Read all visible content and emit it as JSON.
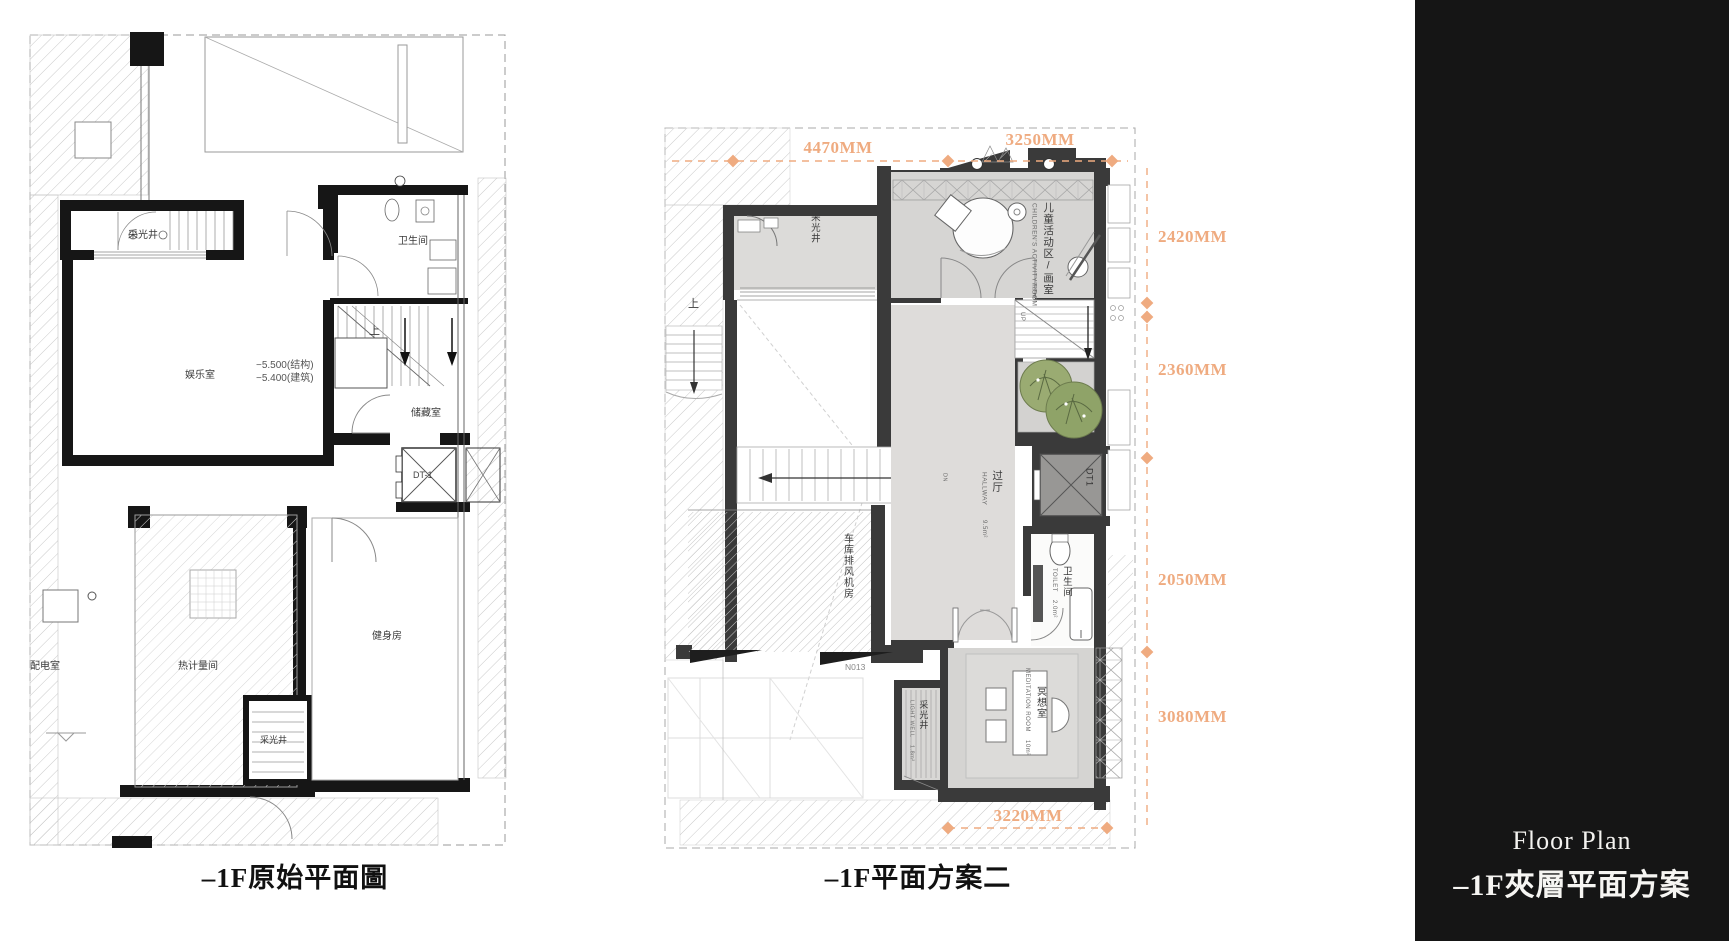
{
  "colors": {
    "dimension_accent": "#efab80",
    "wall_left_plan": "#161616",
    "wall_middle_plan": "#3a3a3a",
    "room_fill": "#d6d5d3",
    "hallway_fill": "#dedcda",
    "tree_green": "#93a56a",
    "panel_background": "#151515",
    "panel_text": "#f4f3f1"
  },
  "left_plan": {
    "caption": "–1F原始平面圖",
    "labels": {
      "light_well_top": "采光井",
      "bathroom": "卫生间",
      "up": "上",
      "entertainment_room": "娱乐室",
      "level_structural": "−5.500(结构)",
      "level_architectural": "−5.400(建筑)",
      "storage_room": "储藏室",
      "elevator": "DT-1",
      "power_room": "配电室",
      "heat_metering_room": "热计量间",
      "gym": "健身房",
      "light_well_bottom": "采光井"
    }
  },
  "middle_plan": {
    "caption": "–1F平面方案二",
    "dimensions": {
      "top_width_left": "4470MM",
      "top_width_right": "3250MM",
      "right_1": "2420MM",
      "right_2": "2360MM",
      "right_3": "2050MM",
      "right_4": "3080MM",
      "bottom_width": "3220MM"
    },
    "labels": {
      "light_well_top": "采光井",
      "children_room_zh": "儿童活动区/画室",
      "children_room_en": "CHILDREN'S ACTIVITY ROOM",
      "children_room_area": "7.7m²",
      "stair_up_zh": "上",
      "stair_up_en": "UP",
      "stair_down_en": "DN",
      "hallway_zh": "过厅",
      "hallway_en": "HALLWAY",
      "hallway_area": "9.5m²",
      "garage_fan_room": "车库排风机房",
      "drain_note": "N013",
      "toilet_zh": "卫生间",
      "toilet_en": "TOILET",
      "toilet_area": "2.0m²",
      "meditation_zh": "冥想室",
      "meditation_en": "MEDITATION ROOM",
      "meditation_area": "10m²",
      "light_well_bottom_zh": "采光井",
      "light_well_bottom_en": "LIGHT WELL",
      "light_well_bottom_area": "1.8m²",
      "elevator": "DT1"
    }
  },
  "side_panel": {
    "title_en": "Floor Plan",
    "title_zh": "–1F夾層平面方案"
  }
}
